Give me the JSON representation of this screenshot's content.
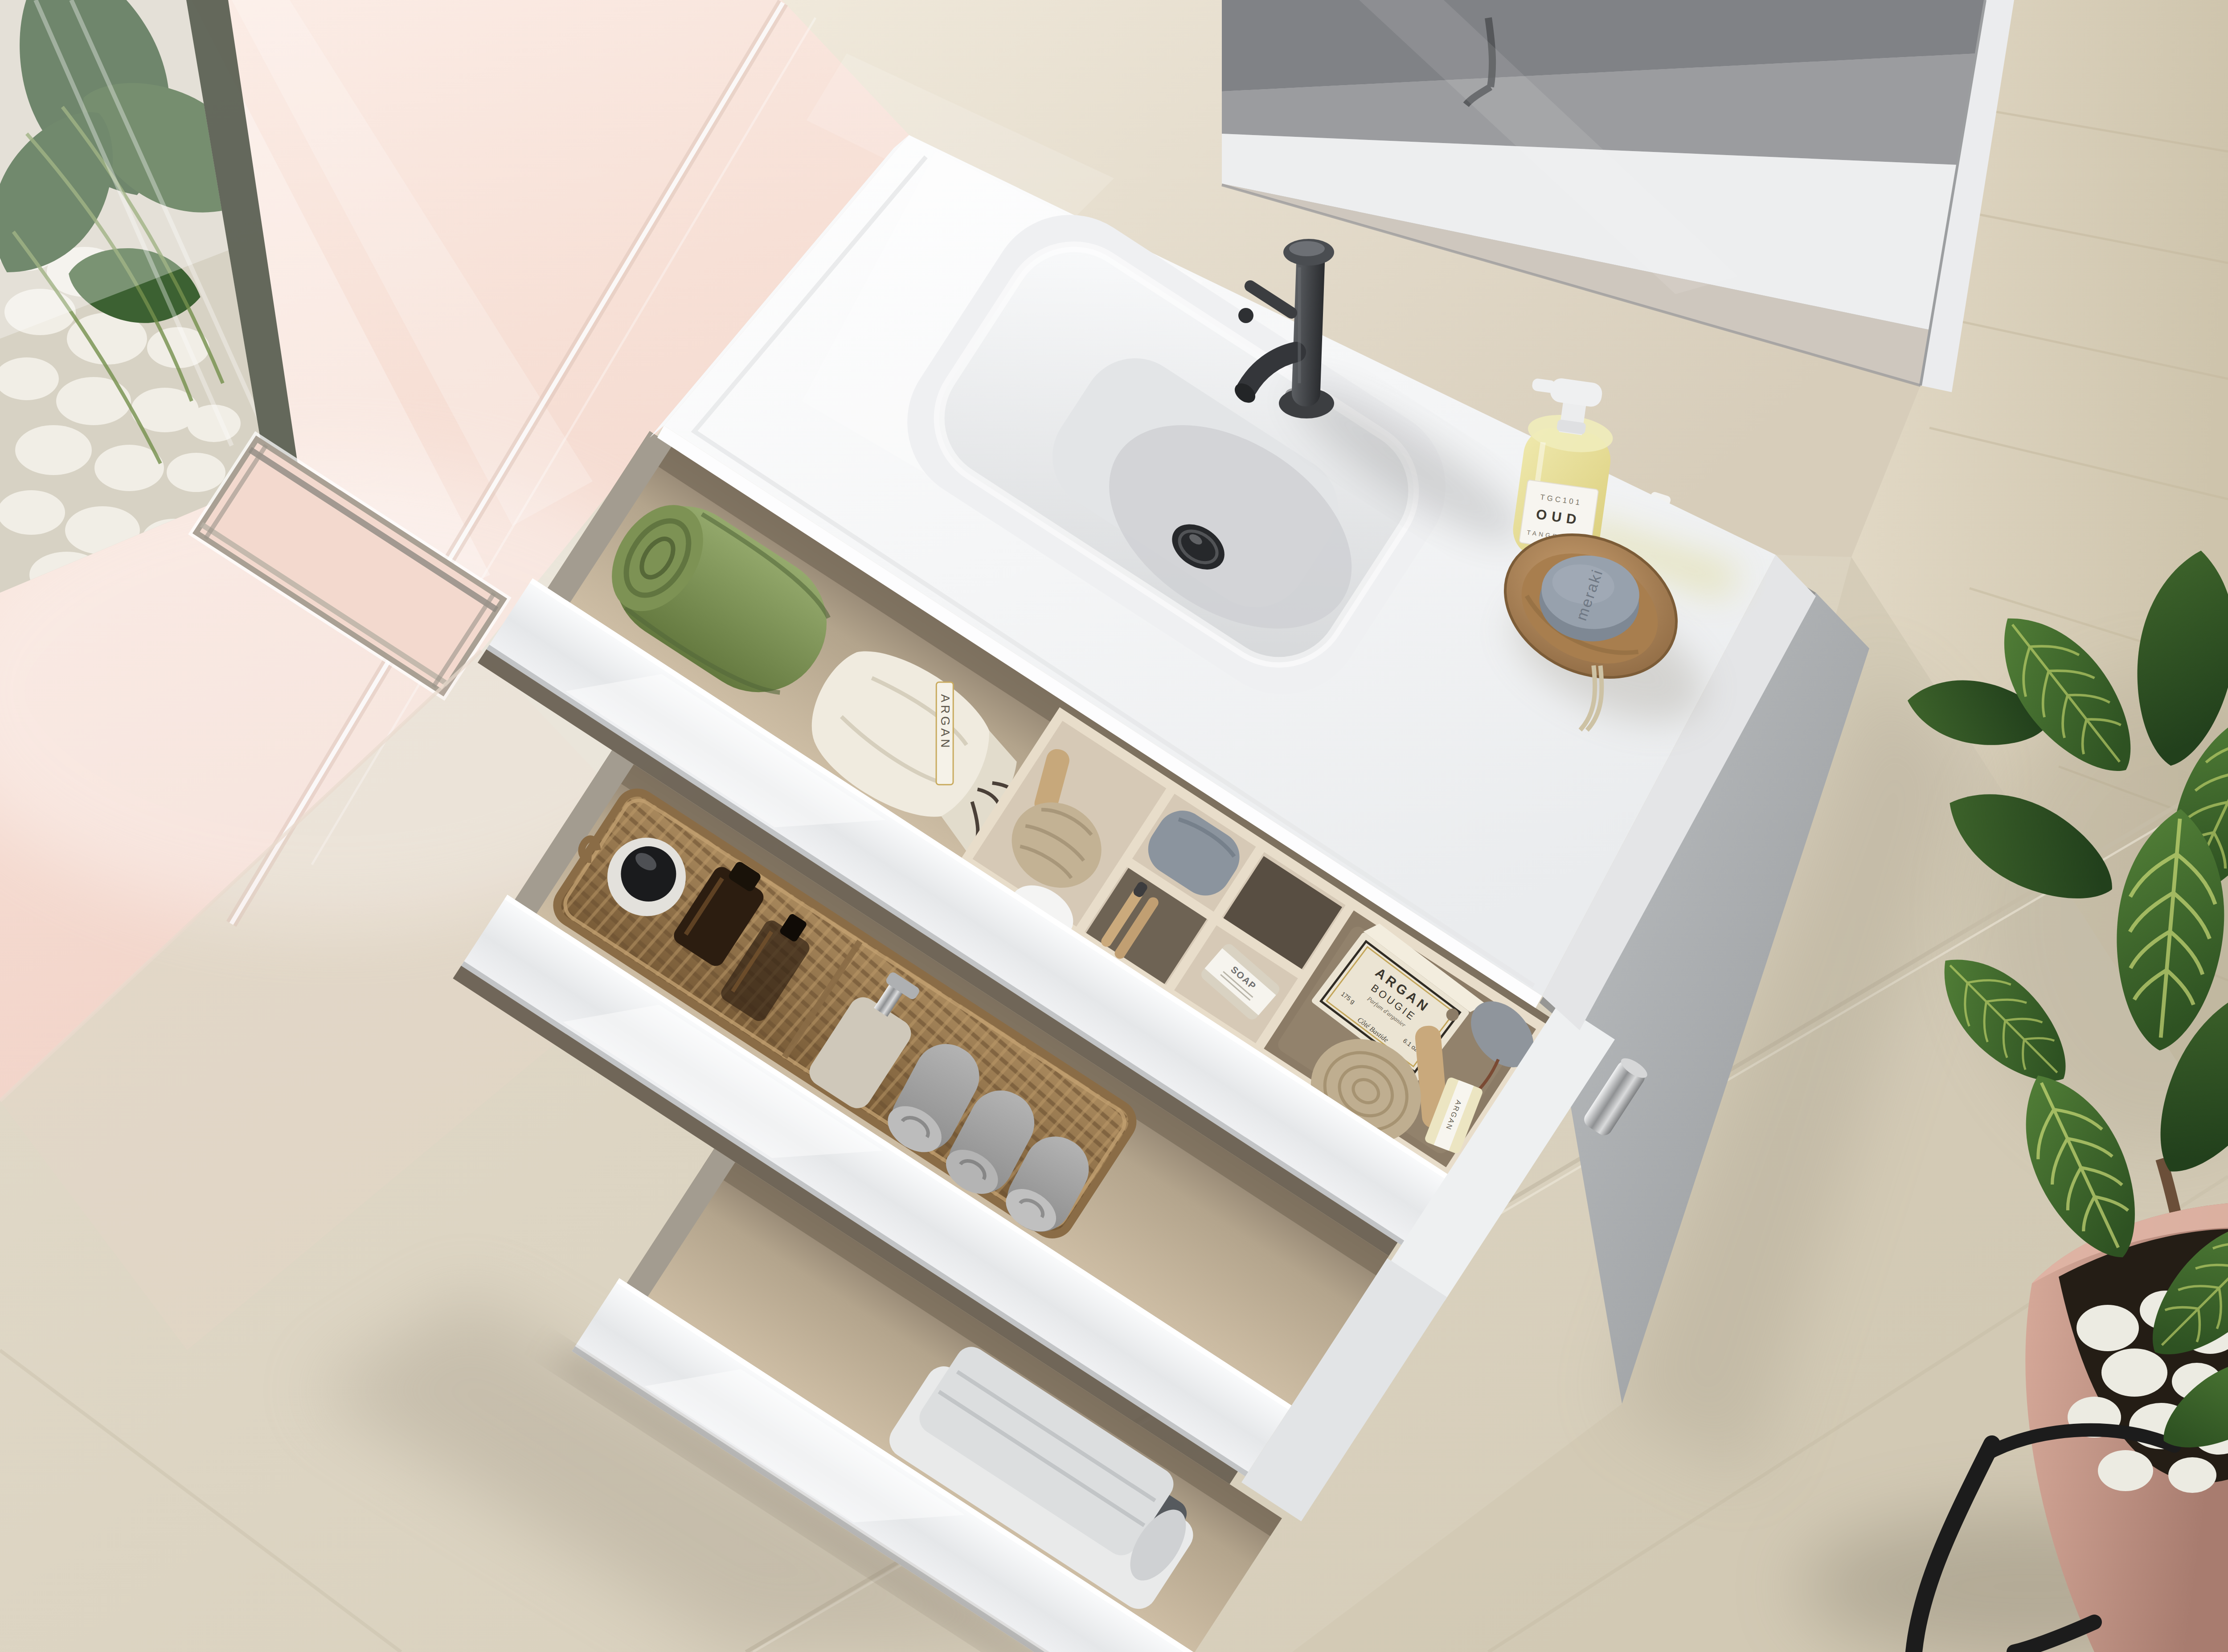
{
  "meta": {
    "description": "Top-down render of a modern bathroom: white vanity with integrated basin and three open cascading drawers, matte black faucet, toiletries, frameless mirror, blush shower wall with linear drain and pebble garden window, travertine wall, beige stone floor and a potted ficus in a dusty-pink planter.",
    "canvas": {
      "width": 5000,
      "height": 3707
    }
  },
  "palette": {
    "pink_wall": "#f6ddd3",
    "stone_wall": "#e3dac9",
    "travertine_wall": "#d8cfba",
    "floor": "#ddd5c5",
    "counter_white": "#f4f5f6",
    "faucet_black": "#34363a",
    "drawer_interior": "#c3b29a",
    "cabinet_side_grey": "#a9acae",
    "towel_green": "#77894f",
    "basket_wicker": "#96774a",
    "soap_liquid_yellow": "#e7e09a",
    "round_soap_grey": "#8d97a3",
    "leaf_green": "#3f6b2e",
    "pot_pink": "#c49386"
  },
  "products": {
    "dispenser_label": {
      "line1": "TGC101",
      "line2": "OUD",
      "line3": "TANGENTGC"
    },
    "round_soap": {
      "embossed": "meraki"
    },
    "candle_box": {
      "title": "ARGAN",
      "subtitle": "BOUGIE",
      "tagline": "Parfum d'arganier",
      "weight": "175 g",
      "volume": "6.1 oz",
      "brand": "C\u00f4t\u00e9 Bastide"
    },
    "wrapped_soap": {
      "label": "SOAP"
    },
    "sachet_tag": {
      "label": "ARGAN"
    },
    "argan_soap": {
      "label": "ARGAN"
    }
  },
  "scene": {
    "room": {
      "walls": [
        "blush pink plaster shower wall",
        "beige limestone backsplash wall",
        "travertine side wall"
      ],
      "floor": "large beige stone tiles with diagonal grout lines"
    },
    "shower": {
      "features": [
        "glass screen edge",
        "rectangular linear floor drain",
        "garden window with white pebbles",
        "monstera and grass foliage"
      ]
    },
    "mirror": {
      "type": "frameless tilted wall mirror",
      "reflection": "white basin, grey wall band and faucet"
    },
    "vanity": {
      "counter": "glossy white mineral-cast top with integrated rectangular basin",
      "faucet": "matte black single-lever mixer with side handle",
      "drain": "matte black pop-up waste",
      "items_on_top": [
        "yellow hand-soap pump bottle",
        "round wooden dish with grey soap on a rope"
      ],
      "drawers": [
        {
          "name": "top drawer",
          "contents": [
            "rolled sage-green towel",
            "tied cotton sachet with ARGAN tag",
            "beige organizer tray",
            "shaving brush",
            "wooden toothbrushes",
            "grey pouch",
            "paper-wrapped SOAP bar",
            "ARGAN BOUGIE candle box",
            "round wooden body brush",
            "grey pumice stone",
            "ARGAN soap bar"
          ]
        },
        {
          "name": "middle drawer",
          "contents": [
            "long wicker basket with handle",
            "cream jar with black lid",
            "two amber glass bottles",
            "beige lotion dispenser with chrome pump",
            "three rolled grey towels"
          ]
        },
        {
          "name": "bottom drawer",
          "contents": [
            "folded white, light-grey and charcoal towels"
          ]
        }
      ],
      "feet": [
        "chrome foot",
        "dark foot"
      ]
    },
    "plant": {
      "type": "tall ficus with large veined leaves",
      "pot": "dusty-pink planter on black metal stand",
      "topping": "white pebbles over dark soil"
    }
  }
}
